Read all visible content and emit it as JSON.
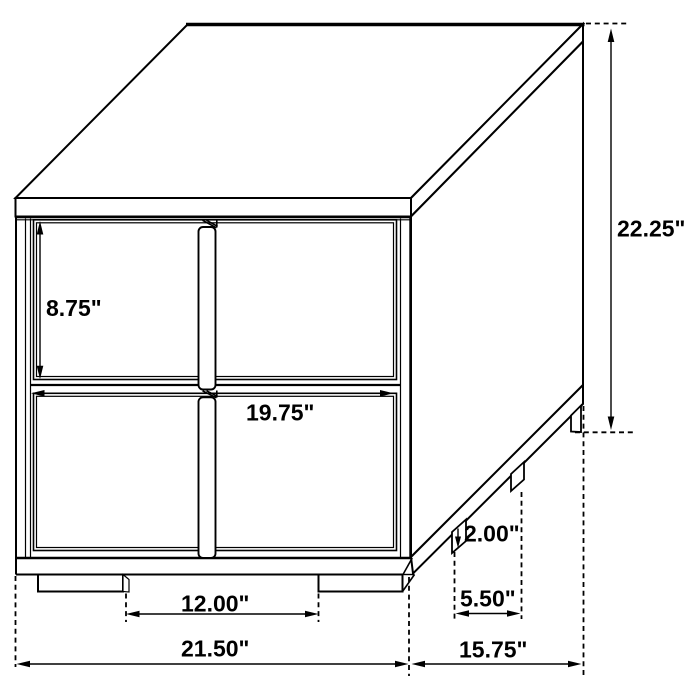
{
  "diagram": {
    "type": "furniture-dimension-diagram",
    "subject": "two-drawer nightstand line drawing, oblique 3D view",
    "colors": {
      "line": "#000000",
      "background": "#ffffff",
      "text": "#000000"
    },
    "labels": {
      "overall_height": "22.25\"",
      "drawer_face_height": "8.75\"",
      "drawer_width": "19.75\"",
      "leg_height": "2.00\"",
      "side_leg_spacing": "5.50\"",
      "front_leg_spacing": "12.00\"",
      "overall_width": "21.50\"",
      "overall_depth": "15.75\""
    }
  }
}
